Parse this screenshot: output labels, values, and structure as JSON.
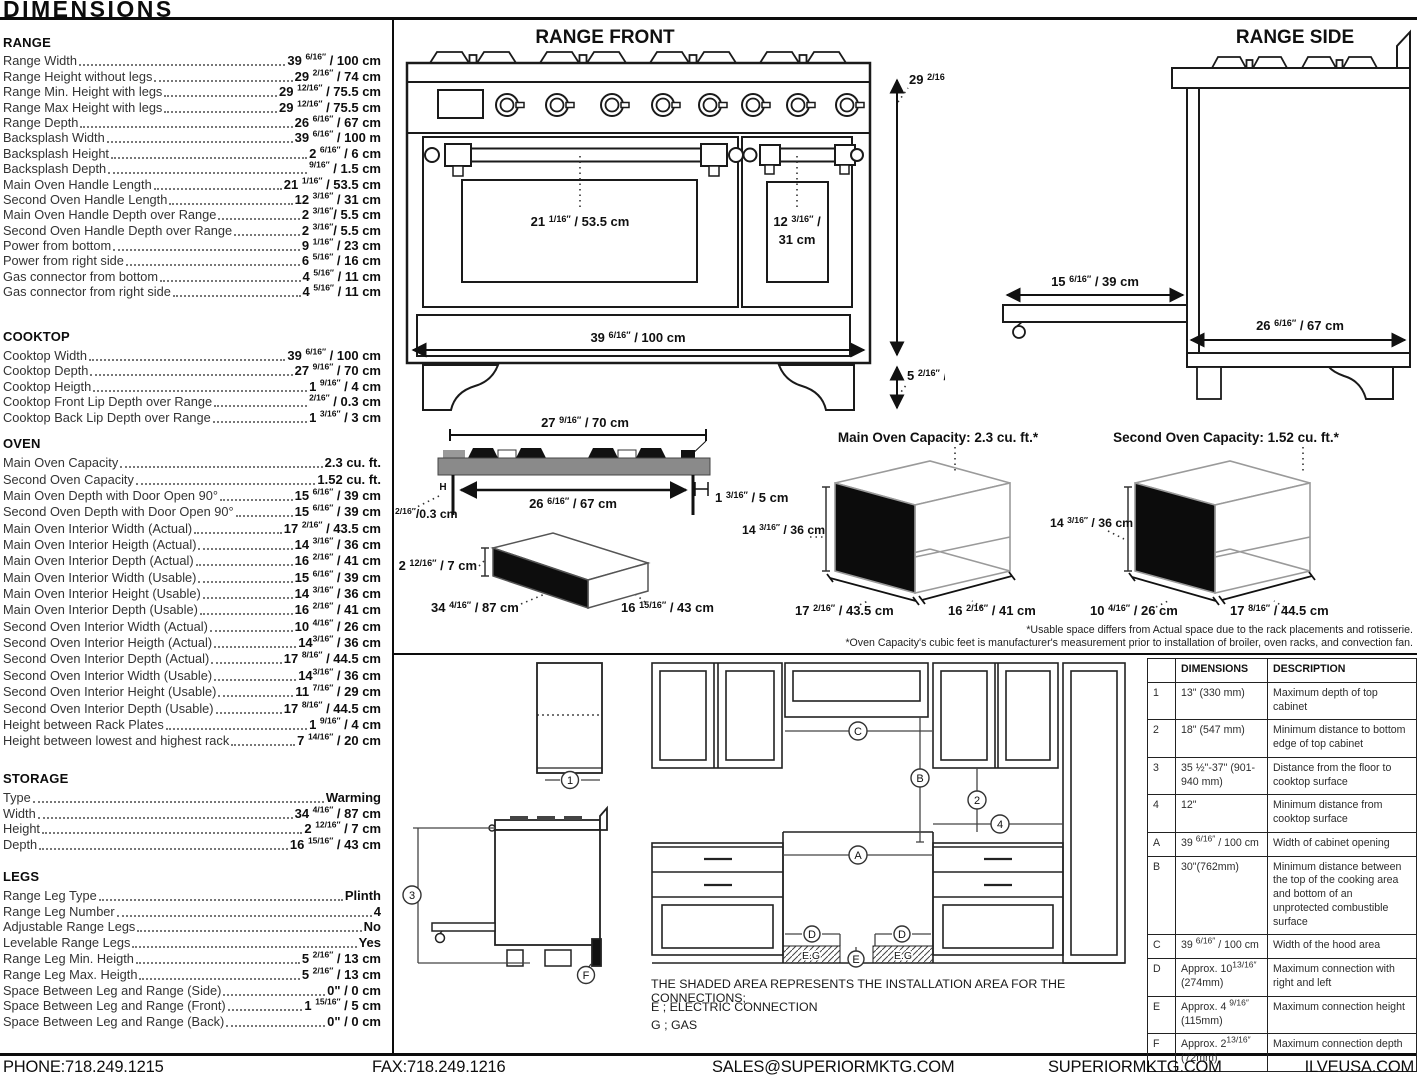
{
  "title": "DIMENSIONS",
  "specs": {
    "range": {
      "heading": "RANGE",
      "items": [
        {
          "l": "Range Width",
          "v": "39 ^6/16″^ / 100 cm"
        },
        {
          "l": "Range Height without legs",
          "v": "29 ^2/16″^ / 74 cm"
        },
        {
          "l": "Range Min. Height with legs",
          "v": "29 ^12/16″^ / 75.5 cm"
        },
        {
          "l": "Range Max Height with legs",
          "v": "29 ^12/16″^ / 75.5 cm"
        },
        {
          "l": "Range Depth",
          "v": "26 ^6/16″^ / 67 cm"
        },
        {
          "l": "Backsplash Width",
          "v": "39 ^6/16″^ / 100 m"
        },
        {
          "l": "Backsplash Height",
          "v": "2 ^6/16″^ / 6 cm"
        },
        {
          "l": "Backsplash Depth",
          "v": "^9/16″^ / 1.5 cm"
        },
        {
          "l": "Main Oven Handle Length",
          "v": "21 ^1/16″^ / 53.5 cm"
        },
        {
          "l": "Second Oven Handle Length",
          "v": "12 ^3/16″^ / 31 cm"
        },
        {
          "l": "Main Oven Handle Depth over Range",
          "v": "2 ^3/16″^/ 5.5 cm"
        },
        {
          "l": "Second Oven Handle Depth over Range",
          "v": "2 ^3/16″^/ 5.5 cm"
        },
        {
          "l": "Power from bottom",
          "v": "9 ^1/16″^ / 23 cm"
        },
        {
          "l": "Power from right side",
          "v": "6 ^5/16″^ / 16 cm"
        },
        {
          "l": "Gas connector from bottom",
          "v": "4 ^5/16″^ / 11 cm"
        },
        {
          "l": "Gas connector from right side",
          "v": "4 ^5/16″^ / 11 cm"
        }
      ]
    },
    "cooktop": {
      "heading": "COOKTOP",
      "items": [
        {
          "l": "Cooktop Width",
          "v": "39 ^6/16″^ / 100 cm"
        },
        {
          "l": "Cooktop Depth",
          "v": "27 ^9/16″^ / 70 cm"
        },
        {
          "l": "Cooktop Heigth",
          "v": "1 ^9/16″^ / 4 cm"
        },
        {
          "l": "Cooktop Front Lip Depth over Range",
          "v": "^2/16″^ / 0.3 cm"
        },
        {
          "l": "Cooktop Back Lip Depth over Range",
          "v": "1 ^3/16″^ / 3 cm"
        }
      ]
    },
    "oven": {
      "heading": "OVEN",
      "items": [
        {
          "l": "Main Oven Capacity",
          "v": "2.3 cu. ft."
        },
        {
          "l": "Second Oven Capacity",
          "v": "1.52 cu. ft."
        },
        {
          "l": "Main Oven Depth with Door Open 90°",
          "v": "15 ^6/16″^ / 39 cm"
        },
        {
          "l": "Second Oven Depth with Door Open 90°",
          "v": "15 ^6/16″^ / 39 cm"
        },
        {
          "l": "Main Oven Interior Width (Actual)",
          "v": "17 ^2/16″^ / 43.5 cm"
        },
        {
          "l": "Main Oven Interior Heigth (Actual)",
          "v": "14 ^3/16″^ / 36 cm"
        },
        {
          "l": "Main Oven Interior Depth (Actual)",
          "v": "16 ^2/16″^ / 41 cm"
        },
        {
          "l": "Main Oven Interior Width (Usable)",
          "v": "15 ^6/16″^ / 39 cm"
        },
        {
          "l": "Main Oven Interior Height (Usable)",
          "v": "14 ^3/16″^ / 36 cm"
        },
        {
          "l": "Main Oven Interior Depth (Usable)",
          "v": "16 ^2/16″^ / 41 cm"
        },
        {
          "l": "Second Oven Interior Width (Actual)",
          "v": "10 ^4/16″^ / 26 cm"
        },
        {
          "l": "Second Oven Interior Heigth (Actual)",
          "v": "14^3/16″^ / 36 cm"
        },
        {
          "l": "Second Oven Interior Depth (Actual)",
          "v": "17 ^8/16″^ / 44.5 cm"
        },
        {
          "l": "Second Oven Interior Width (Usable)",
          "v": "14^3/16″^ / 36 cm"
        },
        {
          "l": "Second Oven Interior Height (Usable)",
          "v": "11 ^7/16″^ / 29 cm"
        },
        {
          "l": "Second Oven Interior Depth (Usable)",
          "v": "17 ^8/16″^ / 44.5 cm"
        },
        {
          "l": "Height between Rack Plates",
          "v": "1 ^9/16″^ / 4 cm"
        },
        {
          "l": "Height between lowest and highest rack",
          "v": "7 ^14/16″^ / 20 cm"
        }
      ]
    },
    "storage": {
      "heading": "STORAGE",
      "items": [
        {
          "l": "Type",
          "v": "Warming"
        },
        {
          "l": "Width",
          "v": "34 ^4/16″^ / 87 cm"
        },
        {
          "l": "Height",
          "v": "2 ^12/16″^ / 7 cm"
        },
        {
          "l": "Depth",
          "v": "16 ^15/16″^ / 43 cm"
        }
      ]
    },
    "legs": {
      "heading": "LEGS",
      "items": [
        {
          "l": "Range Leg Type",
          "v": "Plinth"
        },
        {
          "l": "Range Leg Number",
          "v": "4"
        },
        {
          "l": "Adjustable Range Legs",
          "v": "No"
        },
        {
          "l": "Levelable Range Legs",
          "v": "Yes"
        },
        {
          "l": "Range Leg Min. Heigth",
          "v": "5 ^2/16″^ / 13 cm"
        },
        {
          "l": "Range Leg Max. Heigth",
          "v": "5 ^2/16″^ / 13 cm"
        },
        {
          "l": "Space Between Leg and Range (Side)",
          "v": "0\" / 0 cm"
        },
        {
          "l": "Space Between Leg and Range (Front)",
          "v": "1 ^15/16″^ / 5 cm"
        },
        {
          "l": "Space Between Leg and Range (Back)",
          "v": "0\" / 0 cm"
        }
      ]
    }
  },
  "range_front": {
    "title": "RANGE FRONT",
    "height": "29 ^2/16″^ / 74 cm",
    "main_handle": "21 ^1/16″^ / 53.5 cm",
    "second_handle_l1": "12 ^3/16″^ /",
    "second_handle_l2": "31 cm",
    "width": "39 ^6/16″^ / 100 cm",
    "leg_height": "5 ^2/16″^ / 13"
  },
  "range_side": {
    "title": "RANGE SIDE",
    "drawer_depth": "15 ^6/16″^ / 39 cm",
    "depth": "26 ^6/16″^ / 67 cm"
  },
  "cooktop_fig": {
    "width": "27 ^9/16″^ / 70 cm",
    "inner_width": "26 ^6/16″^ / 67 cm",
    "h": "H",
    "front_lip": "^2/16″^/0.3 cm",
    "back_lip": "1 ^3/16″^ / 5 cm"
  },
  "storage_fig": {
    "height": "2 ^12/16″^ / 7 cm",
    "width": "34 ^4/16″^ / 87 cm",
    "depth": "16 ^15/16″^ / 43 cm"
  },
  "main_oven_fig": {
    "title": "Main Oven Capacity: 2.3 cu. ft.*",
    "height": "14 ^3/16″^ / 36 cm",
    "width": "17 ^2/16″^ / 43.5 cm",
    "depth": "16 ^2/16″^ / 41 cm"
  },
  "second_oven_fig": {
    "title": "Second Oven Capacity: 1.52 cu. ft.*",
    "height": "14 ^3/16″^ / 36 cm",
    "width": "10 ^4/16″^ / 26 cm",
    "depth": "17 ^8/16″^ / 44.5 cm"
  },
  "footnotes": [
    "*Usable space differs from Actual space due to the rack placements and rotisserie.",
    "*Oven Capacity's cubic feet is manufacturer's measurement prior to installation of broiler, oven racks, and convection fan."
  ],
  "install": {
    "callouts": {
      "c1": "1",
      "c2": "2",
      "c3": "3",
      "c4": "4",
      "ca": "A",
      "cb": "B",
      "cc": "C",
      "cd": "D",
      "ce": "E",
      "cf": "F",
      "eg": "E.G"
    },
    "note_line1": "THE SHADED AREA REPRESENTS THE INSTALLATION AREA FOR THE CONNECTIONS;",
    "note_e": "E ; ELECTRIC CONNECTION",
    "note_g": "G ; GAS",
    "table": {
      "headers": {
        "dim": "DIMENSIONS",
        "desc": "DESCRIPTION"
      },
      "rows": [
        {
          "id": "1",
          "dim": "13\" (330 mm)",
          "desc": "Maximum depth of top cabinet"
        },
        {
          "id": "2",
          "dim": "18\" (547 mm)",
          "desc": "Minimum distance to bottom edge of top cabinet"
        },
        {
          "id": "3",
          "dim": "35 ½\"-37\" (901-940 mm)",
          "desc": "Distance from the floor to cooktop surface"
        },
        {
          "id": "4",
          "dim": "12\"",
          "desc": "Minimum distance from cooktop surface"
        },
        {
          "id": "A",
          "dim": "39 ^6/16″^ / 100 cm",
          "desc": "Width of cabinet opening"
        },
        {
          "id": "B",
          "dim": "30\"(762mm)",
          "desc": "Minimum distance between the top of the cooking area and bottom of an unprotected combustible surface"
        },
        {
          "id": "C",
          "dim": "39 ^6/16″^ / 100 cm",
          "desc": "Width of the hood area"
        },
        {
          "id": "D",
          "dim": "Approx. 10^13/16″^ (274mm)",
          "desc": "Maximum connection with right and left"
        },
        {
          "id": "E",
          "dim": "Approx. 4 ^9/16″^ (115mm)",
          "desc": "Maximum connection height"
        },
        {
          "id": "F",
          "dim": "Approx. 2^13/16″^ (72mm)",
          "desc": "Maximum connection depth"
        }
      ]
    }
  },
  "footer": {
    "phone": "PHONE:718.249.1215",
    "fax": "FAX:718.249.1216",
    "email": "SALES@SUPERIORMKTG.COM",
    "website": "SUPERIORMKTG.COM",
    "brand": "ILVEUSA.COM"
  }
}
